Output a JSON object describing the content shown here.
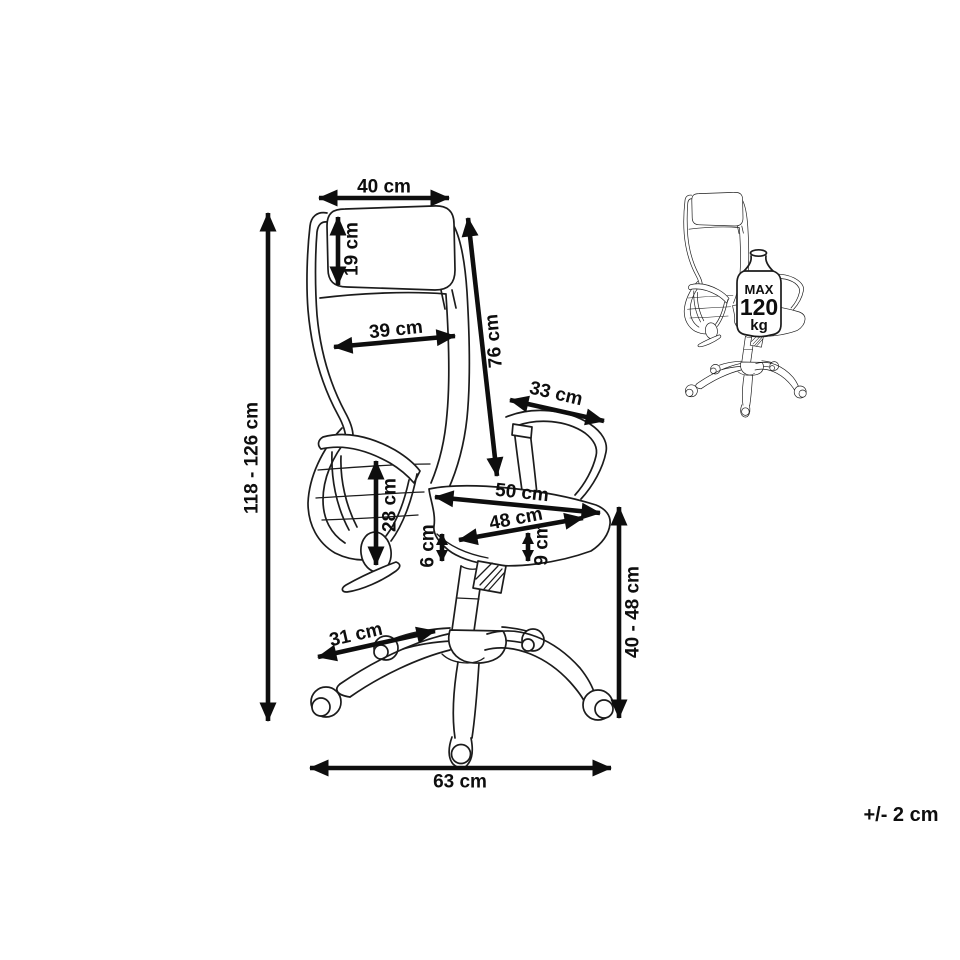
{
  "page": {
    "background": "#ffffff",
    "ink": "#1c1c1c",
    "dimension_color": "#0e0e0e"
  },
  "diagram": {
    "type": "product-dimension-diagram",
    "subject": "office-chair",
    "tolerance_note": "+/- 2 cm",
    "weight_limit": {
      "label_max": "MAX",
      "value": "120",
      "unit": "kg"
    },
    "dimensions": {
      "headrest_width": "40 cm",
      "headrest_height": "19 cm",
      "backrest_width": "39 cm",
      "backrest_height": "76 cm",
      "armrest_length": "33 cm",
      "overall_height": "118 - 126 cm",
      "armrest_height": "28 cm",
      "seat_width": "50 cm",
      "seat_depth": "48 cm",
      "seat_edge_thickness": "6 cm",
      "seat_cushion_thickness": "9 cm",
      "base_leg_length": "31 cm",
      "seat_height": "40 - 48 cm",
      "base_width": "63 cm"
    }
  }
}
